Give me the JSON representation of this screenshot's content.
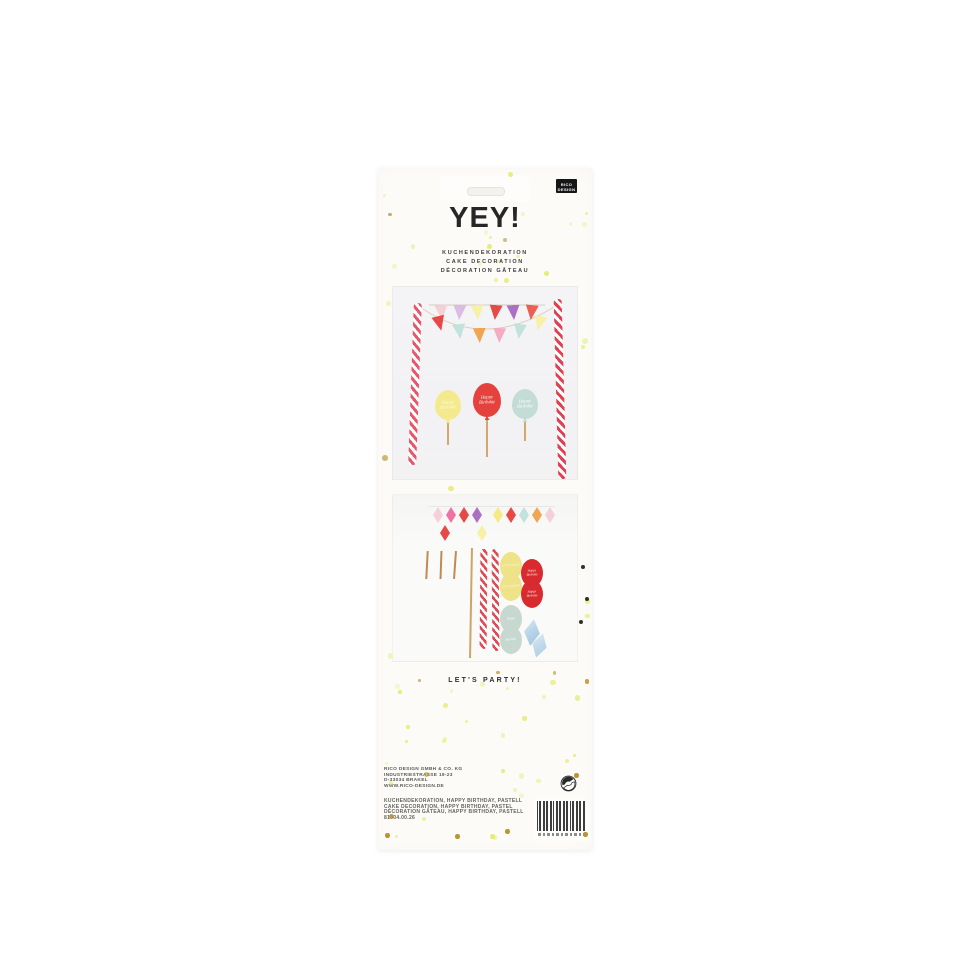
{
  "package": {
    "brand": {
      "line1": "RICO",
      "line2": "DESIGN"
    },
    "title": "YEY!",
    "subtitle_lines": [
      "KUCHENDEKORATION",
      "CAKE DECORATION",
      "DÉCORATION GÂTEAU"
    ],
    "tagline": "LET'S PARTY!",
    "address_lines": [
      "RICO DESIGN GMBH & CO. KG",
      "INDUSTRIESTRASSE 19-23",
      "D-33034 BRAKEL",
      "WWW.RICO-DESIGN.DE"
    ],
    "keyword_lines": [
      "KUCHENDEKORATION, HAPPY BIRTHDAY, PASTELL",
      "CAKE DECORATION, HAPPY BIRTHDAY, PASTEL",
      "DÉCORATION GÂTEAU, HAPPY BIRTHDAY, PASTELL",
      "81004.00.26"
    ]
  },
  "product": {
    "balloon_topper_text": {
      "line1": "Happy",
      "line2": "Birthday"
    },
    "balloon_topper_colors": {
      "yellow": "#f4ea8d",
      "red": "#e5423d",
      "mint": "#c3dcd5"
    },
    "bunting_top_colors": [
      "#f3cdd7",
      "#d9b9e2",
      "#f5f0a2",
      "#e6403c",
      "#a868c0",
      "#ea574b"
    ],
    "bunting_swag_colors": [
      "#e6403c",
      "#bfe0d9",
      "#f0a04a",
      "#f2a9c0",
      "#bfe0d9",
      "#f5f0a2"
    ],
    "diamond_garland_colors": [
      "#f3cdd7",
      "#ef6aa0",
      "#e6403c",
      "#a868c0",
      "#f5e97d",
      "#e6403c",
      "#bfe0d9",
      "#f0a04a",
      "#f3cdd7"
    ],
    "hanging_diamond_colors": [
      "#e6403c",
      "#f5f0a2"
    ],
    "sticker_pair_colors": {
      "yellow": "#efe38a",
      "red": "#d92b2f",
      "mint": "#c7d8d0"
    },
    "gem_sticker_color": "#b9d5e8",
    "straw_stripe_color": "#e8566b",
    "stick_color": "#cfa468"
  },
  "dots": {
    "pale": "#edf2ae",
    "bright": "#e3eb6d",
    "gold": "#bb9434",
    "dark": "#33302a"
  },
  "icons": {
    "green_dot": "green-dot-recycling-icon",
    "barcode": "ean-barcode"
  }
}
